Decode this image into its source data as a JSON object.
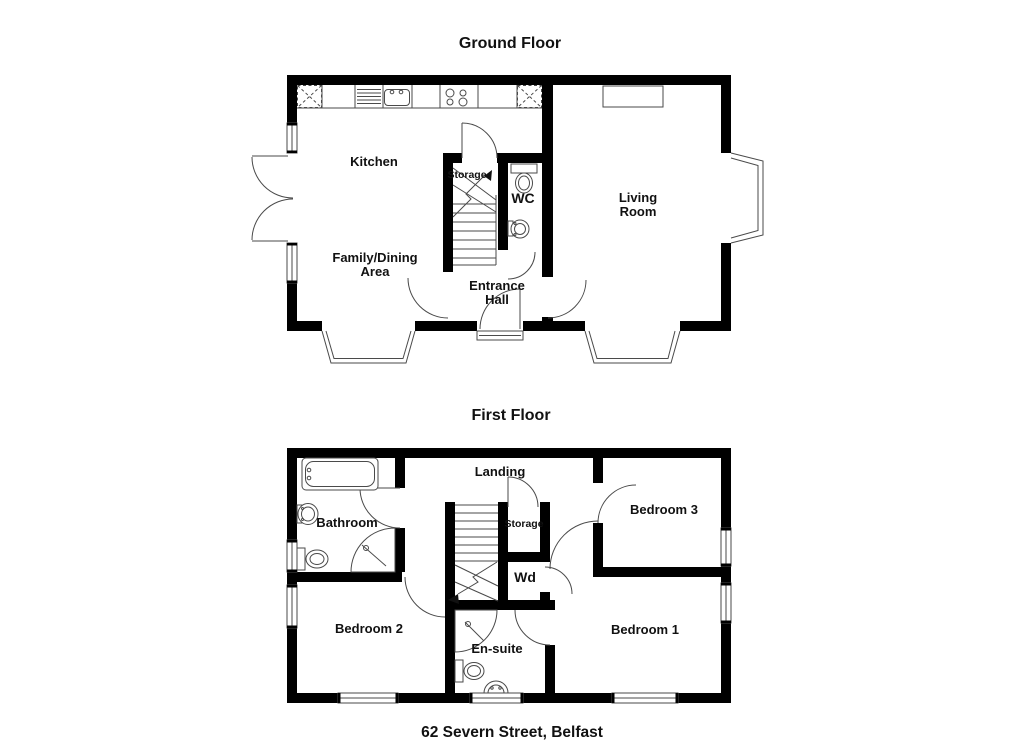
{
  "colors": {
    "wall": "#000000",
    "line": "#4a4a4a",
    "text": "#111111",
    "background": "#ffffff"
  },
  "caption": "62 Severn Street, Belfast",
  "ground_floor": {
    "title": "Ground Floor",
    "labels": {
      "kitchen": "Kitchen",
      "family_dining_line1": "Family/Dining",
      "family_dining_line2": "Area",
      "storage": "Storage",
      "wc": "WC",
      "living_room_line1": "Living",
      "living_room_line2": "Room",
      "entrance_hall_line1": "Entrance",
      "entrance_hall_line2": "Hall"
    }
  },
  "first_floor": {
    "title": "First Floor",
    "labels": {
      "bathroom": "Bathroom",
      "landing": "Landing",
      "storage": "Storage",
      "wardrobe": "Wd",
      "bedroom1": "Bedroom 1",
      "bedroom2": "Bedroom 2",
      "bedroom3": "Bedroom 3",
      "ensuite": "En-suite"
    }
  }
}
